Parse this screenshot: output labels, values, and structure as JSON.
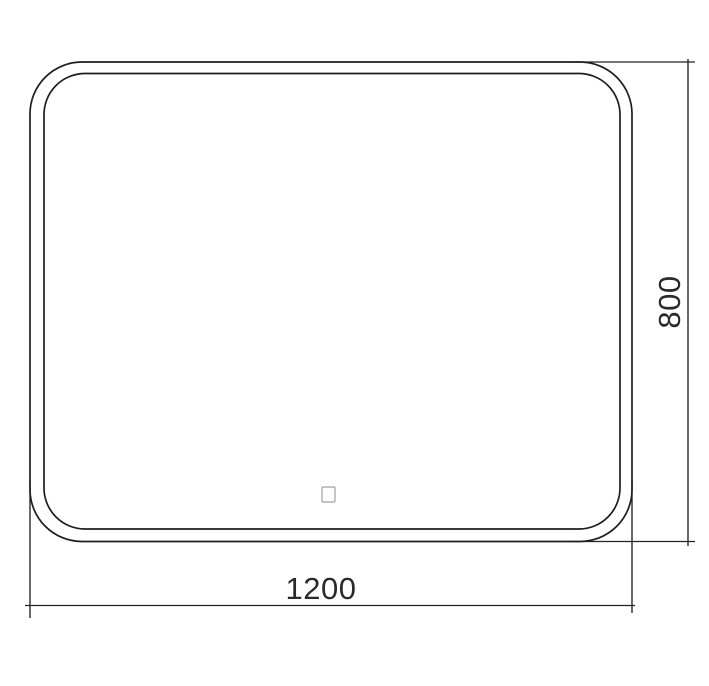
{
  "drawing": {
    "title": "mirror-dimension-drawing",
    "dimensions": {
      "width_label": "1200",
      "height_label": "800"
    },
    "colors": {
      "line": "#1e1e1e",
      "dimension_line": "#232323",
      "text": "#2a2a2a",
      "sensor_outline": "#a0a0a0",
      "background": "#ffffff"
    },
    "icons": {
      "touch_sensor": "small-square-outline"
    }
  }
}
